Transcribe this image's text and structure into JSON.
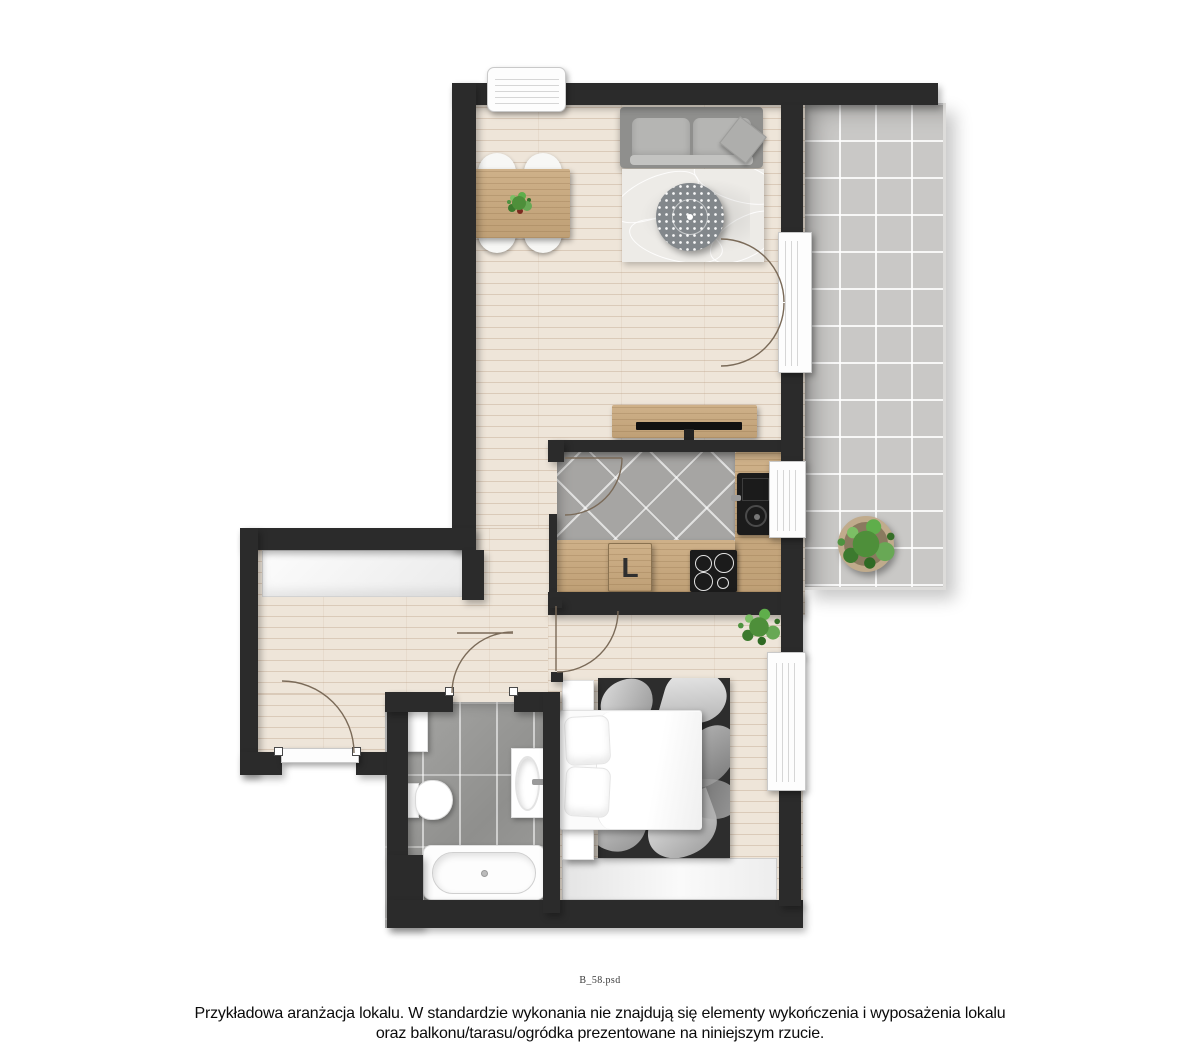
{
  "caption": {
    "file_label": "B_58.psd"
  },
  "disclaimer": {
    "line1": "Przykładowa aranżacja lokalu. W standardzie wykonania nie znajdują się elementy wykończenia i wyposażenia lokalu",
    "line2": "oraz balkonu/tarasu/ogródka prezentowane na niniejszym rzucie."
  },
  "plan": {
    "kitchen": {
      "cabinet_label": "L"
    },
    "colors": {
      "wall": "#2b2b2b",
      "wood_floor": "#eee5d9",
      "wood_plank_line": "#d8c9ba",
      "wood_furniture": "#c9a87c",
      "balcony_tile": "#c9c8c6",
      "kitchen_tile": "#a6a5a3",
      "bathroom_tile": "#9b9b9b",
      "grout_white": "#ffffff",
      "sofa_gray": "#9a9a9a",
      "living_rug": "#edebe7",
      "bedroom_rug_dark": "#2d2d2d",
      "appliance_black": "#1b1b1b",
      "fixture_white": "#ffffff",
      "plant_green": "#4e8f3a",
      "door_arc_brown": "#7a6a58"
    }
  }
}
